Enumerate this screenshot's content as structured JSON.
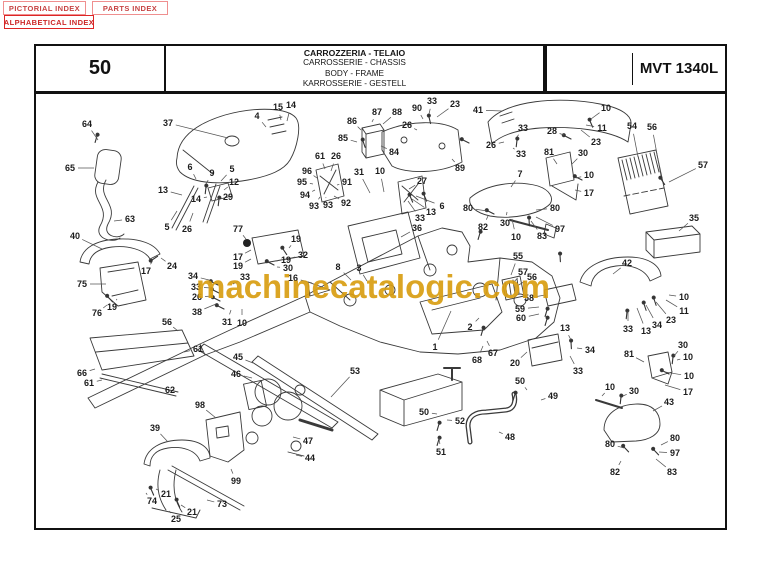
{
  "index_buttons": {
    "pictorial": "PICTORIAL INDEX",
    "parts": "PARTS INDEX",
    "alphabetical": "ALPHABETICAL INDEX"
  },
  "header": {
    "page_number": "50",
    "titles": [
      "CARROZZERIA - TELAIO",
      "CARROSSERIE - CHASSIS",
      "BODY - FRAME",
      "KARROSSERIE - GESTELL"
    ],
    "model": "MVT 1340L"
  },
  "watermark": {
    "text": "machinecatalogic.com",
    "color": "#D99E12"
  },
  "colors": {
    "line": "#3a3a3a",
    "callout_text": "#1c1c1c",
    "leader": "#555555",
    "button_border": "#ef8f8f",
    "alpha_button_border": "#dd2525",
    "button_text": "#c64444"
  },
  "diagram": {
    "callout_format": [
      "label",
      "x",
      "y",
      "leader_x",
      "leader_y"
    ],
    "callouts": [
      [
        "37",
        168,
        123,
        228,
        138
      ],
      [
        "4",
        257,
        116,
        266,
        127
      ],
      [
        "15",
        278,
        107,
        281,
        120
      ],
      [
        "14",
        291,
        105,
        287,
        121
      ],
      [
        "64",
        87,
        124,
        98,
        140
      ],
      [
        "65",
        70,
        168,
        94,
        168
      ],
      [
        "63",
        130,
        219,
        114,
        221
      ],
      [
        "13",
        163,
        190,
        182,
        195
      ],
      [
        "6",
        190,
        167,
        196,
        179
      ],
      [
        "9",
        212,
        173,
        206,
        184
      ],
      [
        "5",
        232,
        169,
        221,
        181
      ],
      [
        "12",
        234,
        182,
        224,
        190
      ],
      [
        "14",
        196,
        199,
        207,
        197
      ],
      [
        "29",
        228,
        197,
        216,
        200
      ],
      [
        "5",
        167,
        227,
        177,
        211
      ],
      [
        "26",
        187,
        229,
        193,
        213
      ],
      [
        "77",
        238,
        229,
        246,
        239
      ],
      [
        "40",
        75,
        236,
        102,
        249
      ],
      [
        "24",
        172,
        266,
        161,
        258
      ],
      [
        "17",
        146,
        271,
        152,
        262
      ],
      [
        "75",
        82,
        284,
        106,
        284
      ],
      [
        "76",
        97,
        313,
        107,
        305
      ],
      [
        "19",
        112,
        307,
        117,
        299
      ],
      [
        "34",
        193,
        276,
        209,
        280
      ],
      [
        "33",
        196,
        287,
        211,
        288
      ],
      [
        "26",
        197,
        297,
        212,
        296
      ],
      [
        "38",
        197,
        312,
        216,
        304
      ],
      [
        "31",
        227,
        322,
        231,
        310
      ],
      [
        "10",
        242,
        323,
        242,
        309
      ],
      [
        "33",
        245,
        277,
        233,
        284
      ],
      [
        "17",
        238,
        257,
        251,
        250
      ],
      [
        "19",
        238,
        266,
        251,
        259
      ],
      [
        "19",
        296,
        239,
        289,
        248
      ],
      [
        "32",
        303,
        255,
        291,
        258
      ],
      [
        "19",
        286,
        260,
        276,
        261
      ],
      [
        "30",
        288,
        268,
        277,
        267
      ],
      [
        "16",
        293,
        278,
        312,
        283
      ],
      [
        "8",
        338,
        267,
        351,
        280
      ],
      [
        "3",
        359,
        268,
        367,
        281
      ],
      [
        "56",
        167,
        322,
        178,
        331
      ],
      [
        "61",
        198,
        349,
        184,
        352
      ],
      [
        "66",
        82,
        373,
        95,
        369
      ],
      [
        "61",
        89,
        383,
        102,
        380
      ],
      [
        "62",
        170,
        390,
        157,
        387
      ],
      [
        "98",
        200,
        405,
        216,
        418
      ],
      [
        "39",
        155,
        428,
        168,
        442
      ],
      [
        "99",
        236,
        481,
        231,
        469
      ],
      [
        "21",
        166,
        494,
        156,
        489
      ],
      [
        "74",
        152,
        501,
        146,
        493
      ],
      [
        "21",
        192,
        512,
        181,
        505
      ],
      [
        "25",
        176,
        519,
        169,
        511
      ],
      [
        "73",
        222,
        504,
        207,
        500
      ],
      [
        "45",
        238,
        357,
        253,
        363
      ],
      [
        "46",
        236,
        374,
        252,
        378
      ],
      [
        "47",
        308,
        441,
        293,
        437
      ],
      [
        "44",
        310,
        458,
        296,
        455
      ],
      [
        "53",
        355,
        371,
        331,
        397
      ],
      [
        "36",
        417,
        228,
        401,
        237
      ],
      [
        "31",
        359,
        172,
        370,
        193
      ],
      [
        "10",
        380,
        171,
        384,
        192
      ],
      [
        "27",
        422,
        181,
        409,
        189
      ],
      [
        "33",
        420,
        218,
        408,
        201
      ],
      [
        "13",
        431,
        212,
        412,
        199
      ],
      [
        "6",
        442,
        206,
        416,
        196
      ],
      [
        "61",
        320,
        156,
        325,
        169
      ],
      [
        "26",
        336,
        156,
        331,
        171
      ],
      [
        "96",
        307,
        171,
        317,
        178
      ],
      [
        "95",
        302,
        182,
        313,
        184
      ],
      [
        "94",
        305,
        195,
        315,
        190
      ],
      [
        "93",
        314,
        206,
        320,
        197
      ],
      [
        "93",
        328,
        205,
        326,
        198
      ],
      [
        "92",
        346,
        203,
        334,
        196
      ],
      [
        "91",
        347,
        182,
        337,
        185
      ],
      [
        "86",
        352,
        121,
        361,
        130
      ],
      [
        "85",
        343,
        138,
        357,
        142
      ],
      [
        "87",
        377,
        112,
        372,
        122
      ],
      [
        "88",
        397,
        112,
        383,
        124
      ],
      [
        "84",
        394,
        152,
        381,
        146
      ],
      [
        "90",
        417,
        108,
        423,
        119
      ],
      [
        "33",
        432,
        101,
        429,
        114
      ],
      [
        "23",
        455,
        104,
        437,
        117
      ],
      [
        "26",
        407,
        125,
        417,
        130
      ],
      [
        "89",
        460,
        168,
        452,
        159
      ],
      [
        "41",
        478,
        110,
        502,
        111
      ],
      [
        "26",
        491,
        145,
        504,
        142
      ],
      [
        "33",
        523,
        128,
        517,
        137
      ],
      [
        "33",
        521,
        154,
        513,
        148
      ],
      [
        "28",
        552,
        131,
        564,
        135
      ],
      [
        "10",
        606,
        108,
        591,
        119
      ],
      [
        "11",
        602,
        128,
        586,
        125
      ],
      [
        "23",
        596,
        142,
        581,
        130
      ],
      [
        "54",
        632,
        126,
        638,
        157
      ],
      [
        "56",
        652,
        127,
        661,
        176
      ],
      [
        "57",
        703,
        165,
        669,
        182
      ],
      [
        "35",
        694,
        218,
        679,
        231
      ],
      [
        "7",
        520,
        174,
        511,
        187
      ],
      [
        "80",
        468,
        208,
        487,
        211
      ],
      [
        "82",
        483,
        227,
        488,
        216
      ],
      [
        "30",
        505,
        223,
        507,
        212
      ],
      [
        "10",
        516,
        237,
        512,
        219
      ],
      [
        "83",
        542,
        236,
        531,
        221
      ],
      [
        "97",
        560,
        229,
        536,
        217
      ],
      [
        "80",
        555,
        208,
        536,
        210
      ],
      [
        "81",
        549,
        152,
        557,
        164
      ],
      [
        "30",
        583,
        153,
        572,
        164
      ],
      [
        "10",
        589,
        175,
        576,
        178
      ],
      [
        "17",
        589,
        193,
        575,
        190
      ],
      [
        "55",
        518,
        256,
        511,
        275
      ],
      [
        "57",
        523,
        272,
        513,
        283
      ],
      [
        "56",
        532,
        277,
        517,
        286
      ],
      [
        "58",
        529,
        298,
        545,
        295
      ],
      [
        "59",
        520,
        309,
        539,
        307
      ],
      [
        "60",
        521,
        318,
        539,
        314
      ],
      [
        "2",
        470,
        327,
        479,
        318
      ],
      [
        "1",
        435,
        347,
        451,
        311
      ],
      [
        "67",
        493,
        353,
        487,
        341
      ],
      [
        "68",
        477,
        360,
        483,
        346
      ],
      [
        "20",
        515,
        363,
        527,
        352
      ],
      [
        "42",
        627,
        263,
        613,
        274
      ],
      [
        "10",
        684,
        297,
        669,
        295
      ],
      [
        "11",
        684,
        311,
        666,
        300
      ],
      [
        "23",
        671,
        320,
        656,
        302
      ],
      [
        "34",
        657,
        325,
        646,
        305
      ],
      [
        "13",
        646,
        331,
        637,
        308
      ],
      [
        "33",
        628,
        329,
        628,
        311
      ],
      [
        "13",
        565,
        328,
        571,
        340
      ],
      [
        "34",
        590,
        350,
        577,
        348
      ],
      [
        "33",
        578,
        371,
        570,
        356
      ],
      [
        "49",
        553,
        396,
        541,
        400
      ],
      [
        "50",
        520,
        381,
        527,
        390
      ],
      [
        "50",
        424,
        412,
        437,
        414
      ],
      [
        "52",
        460,
        421,
        447,
        420
      ],
      [
        "51",
        441,
        452,
        439,
        438
      ],
      [
        "48",
        510,
        437,
        499,
        432
      ],
      [
        "30",
        634,
        391,
        623,
        396
      ],
      [
        "10",
        610,
        387,
        602,
        396
      ],
      [
        "43",
        669,
        402,
        653,
        411
      ],
      [
        "30",
        683,
        345,
        674,
        356
      ],
      [
        "10",
        688,
        357,
        677,
        360
      ],
      [
        "10",
        689,
        376,
        665,
        372
      ],
      [
        "17",
        688,
        392,
        665,
        385
      ],
      [
        "81",
        629,
        354,
        644,
        362
      ],
      [
        "80",
        610,
        444,
        624,
        448
      ],
      [
        "80",
        675,
        438,
        661,
        445
      ],
      [
        "97",
        675,
        453,
        659,
        452
      ],
      [
        "82",
        615,
        472,
        621,
        461
      ],
      [
        "83",
        672,
        472,
        656,
        459
      ]
    ]
  }
}
